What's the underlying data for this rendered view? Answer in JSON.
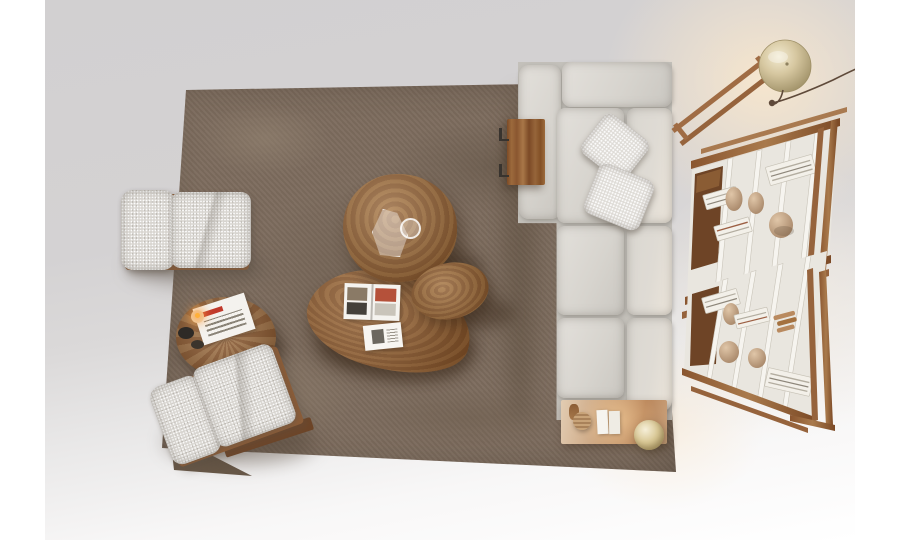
{
  "meta": {
    "description": "Top-down studio photograph of a modern living-room furniture arrangement",
    "canvas": "900x540"
  },
  "palette": {
    "wall_white": "#ffffff",
    "floor_gray": "#d4d2d3",
    "rug_base": "#7d6c5e",
    "rug_shadow": "#685848",
    "sofa_fabric": "#dcd9d4",
    "boucle_fabric": "#d8d5d0",
    "walnut_dark": "#6e4426",
    "walnut_mid": "#9c6a45",
    "walnut_light": "#b98a5f",
    "wood_blond": "#caa27c",
    "shelf_cream": "#e9e6df",
    "panel_white": "#f6f4ef",
    "book_white": "#f3f0e9",
    "book_stripe": "#b3ada0",
    "ceramic_tan": "#c2a387",
    "brass": "#d6c7a0",
    "brass_deep": "#9e8f66",
    "flame_orange": "#ffb03a",
    "magazine_red": "#c0392b",
    "cord_brown": "#5f4a3a"
  },
  "objects": {
    "floor": {
      "label": "light grey studio floor fading to white"
    },
    "rug": {
      "label": "large square taupe suede rug"
    },
    "sofa": {
      "label": "light grey modular sofa with chaise, three seats and backrest"
    },
    "pillows": {
      "label": "two textured boucle cushions on sofa"
    },
    "sofa_side_table": {
      "label": "rectangular walnut side table clipped to sofa"
    },
    "console": {
      "label": "blond wood console at sofa end with books, woven box and brass sphere lamp"
    },
    "armchair_top": {
      "label": "boucle armchair with walnut frame"
    },
    "armchair_bottom": {
      "label": "second boucle armchair, rotated on rug corner"
    },
    "drum_table": {
      "label": "round walnut drum side table with lit candle, bowls and magazine"
    },
    "coffee_table_round": {
      "label": "large round walnut coffee table with glass vases"
    },
    "coffee_table_oval": {
      "label": "oval walnut coffee table"
    },
    "coffee_table_pebble": {
      "label": "pebble-shaped walnut coffee table with open magazine and booklet"
    },
    "bookshelf_upper": {
      "label": "walnut and cream open shelving unit with books and ceramic vases"
    },
    "bookshelf_lower": {
      "label": "second walnut and cream shelving unit"
    },
    "floor_lamp": {
      "label": "brass dome floor lamp on walnut ladder stand with trailing cord"
    }
  }
}
